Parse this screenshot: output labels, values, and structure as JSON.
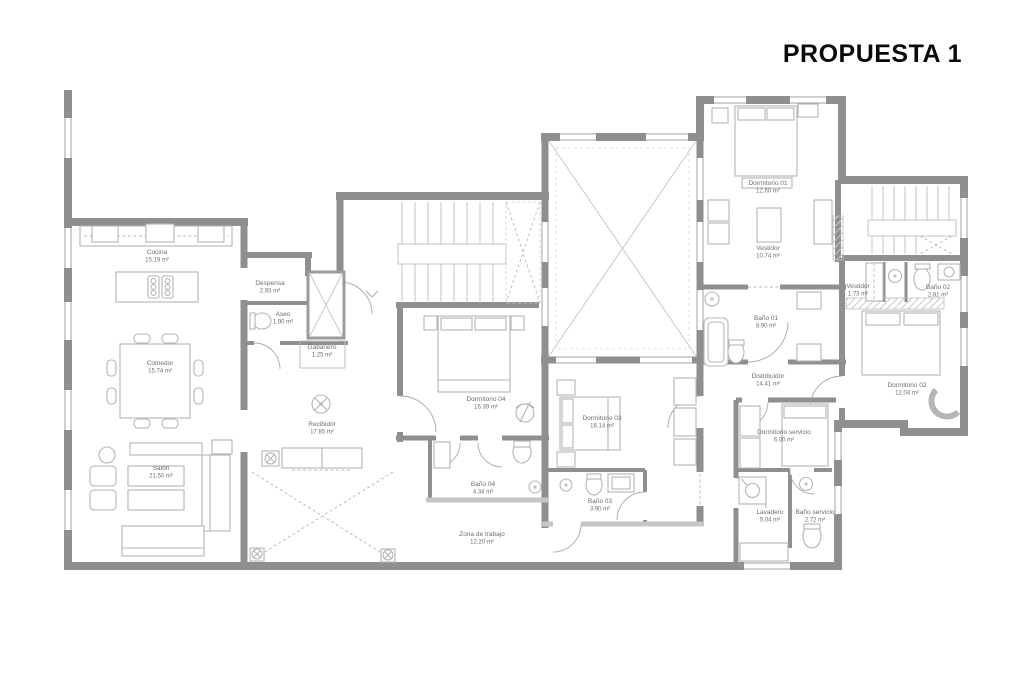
{
  "title": "PROPUESTA 1",
  "colors": {
    "wall": "#8f8f8f",
    "wall_light": "#c6c6c6",
    "furniture": "#b5b5b5",
    "label": "#6e6e6e",
    "title": "#0a0a0a",
    "background": "#ffffff"
  },
  "plan": {
    "units": "m²",
    "rooms": [
      {
        "name": "Cocina",
        "area": "15.19 m²",
        "x": 157,
        "y": 254
      },
      {
        "name": "Despensa",
        "area": "2.93 m²",
        "x": 270,
        "y": 285
      },
      {
        "name": "Aseo",
        "area": "1.90 m²",
        "x": 283,
        "y": 316
      },
      {
        "name": "Comedor",
        "area": "15.74 m²",
        "x": 160,
        "y": 365
      },
      {
        "name": "Salón",
        "area": "21.50 m²",
        "x": 161,
        "y": 470
      },
      {
        "name": "Gabanero",
        "area": "1.25 m²",
        "x": 322,
        "y": 349
      },
      {
        "name": "Recibidor",
        "area": "17.85 m²",
        "x": 322,
        "y": 426
      },
      {
        "name": "Dormitorio 04",
        "area": "16.39 m²",
        "x": 486,
        "y": 401
      },
      {
        "name": "Baño 04",
        "area": "4.34 m²",
        "x": 483,
        "y": 486
      },
      {
        "name": "Zona de trabajo",
        "area": "12.20 m²",
        "x": 482,
        "y": 536
      },
      {
        "name": "Dormitorio 03",
        "area": "16.14 m²",
        "x": 602,
        "y": 420
      },
      {
        "name": "Baño 03",
        "area": "3.90 m²",
        "x": 600,
        "y": 503
      },
      {
        "name": "Dormitorio 01",
        "area": "12.60 m²",
        "x": 768,
        "y": 185
      },
      {
        "name": "Vestidor",
        "area": "10.74 m²",
        "x": 768,
        "y": 250
      },
      {
        "name": "Baño 01",
        "area": "8.90 m²",
        "x": 766,
        "y": 320
      },
      {
        "name": "Distribuidor",
        "area": "14.41 m²",
        "x": 768,
        "y": 378
      },
      {
        "name": "Vestidor",
        "area": "1.73 m²",
        "x": 858,
        "y": 288
      },
      {
        "name": "Baño 02",
        "area": "2.81 m²",
        "x": 938,
        "y": 289
      },
      {
        "name": "Dormitorio 02",
        "area": "12.04 m²",
        "x": 907,
        "y": 387
      },
      {
        "name": "Dormitorio servicio",
        "area": "6.00 m²",
        "x": 784,
        "y": 434
      },
      {
        "name": "Lavadero",
        "area": "5.04 m²",
        "x": 770,
        "y": 514
      },
      {
        "name": "Baño servicio",
        "area": "2.72 m²",
        "x": 815,
        "y": 514
      }
    ]
  }
}
